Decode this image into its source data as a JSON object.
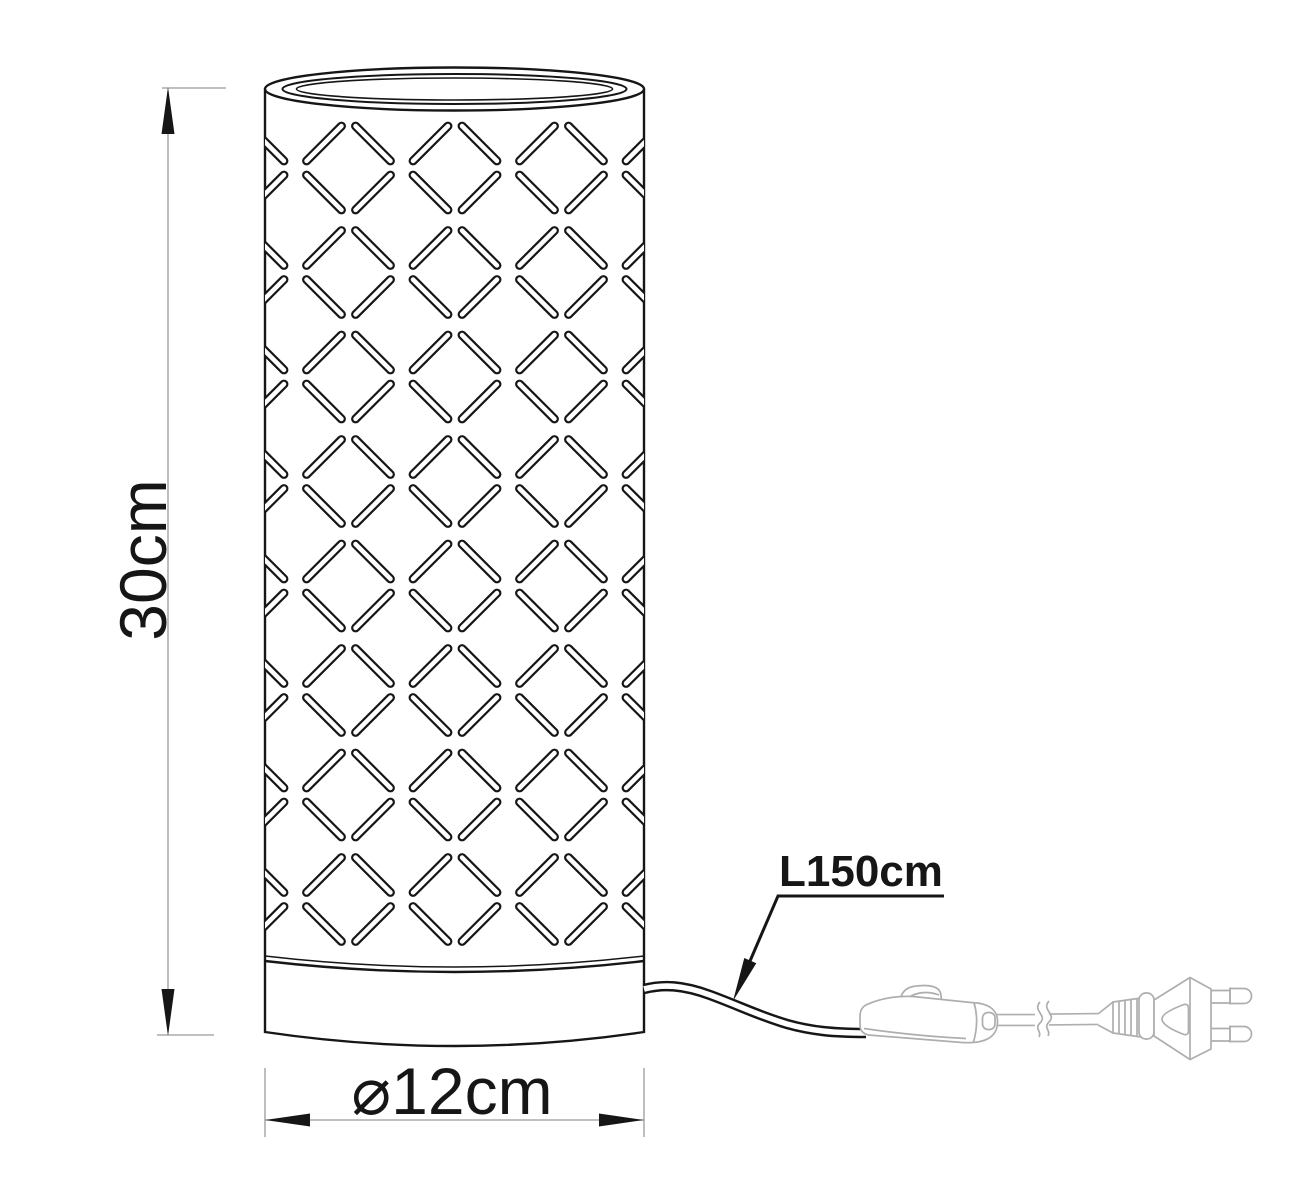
{
  "drawing": {
    "kind": "table-lamp dimension drawing",
    "labels": {
      "height": "30cm",
      "diameter": "⌀12cm",
      "cable_length": "L150cm"
    },
    "colors": {
      "ink": "#161616",
      "dimension_gray": "#9a9a9a",
      "hardware_gray": "#aeaeae",
      "background": "#ffffff"
    },
    "lattice": {
      "column_centers": [
        242,
        348.5,
        455,
        561.5,
        668
      ],
      "row_centers": [
        168,
        272.5,
        377,
        481.5,
        586,
        690.5,
        795,
        899.5
      ],
      "half_diagonal": 49,
      "corner_trim": 10,
      "outer_stroke": 9,
      "inner_stroke": 4.6
    }
  }
}
